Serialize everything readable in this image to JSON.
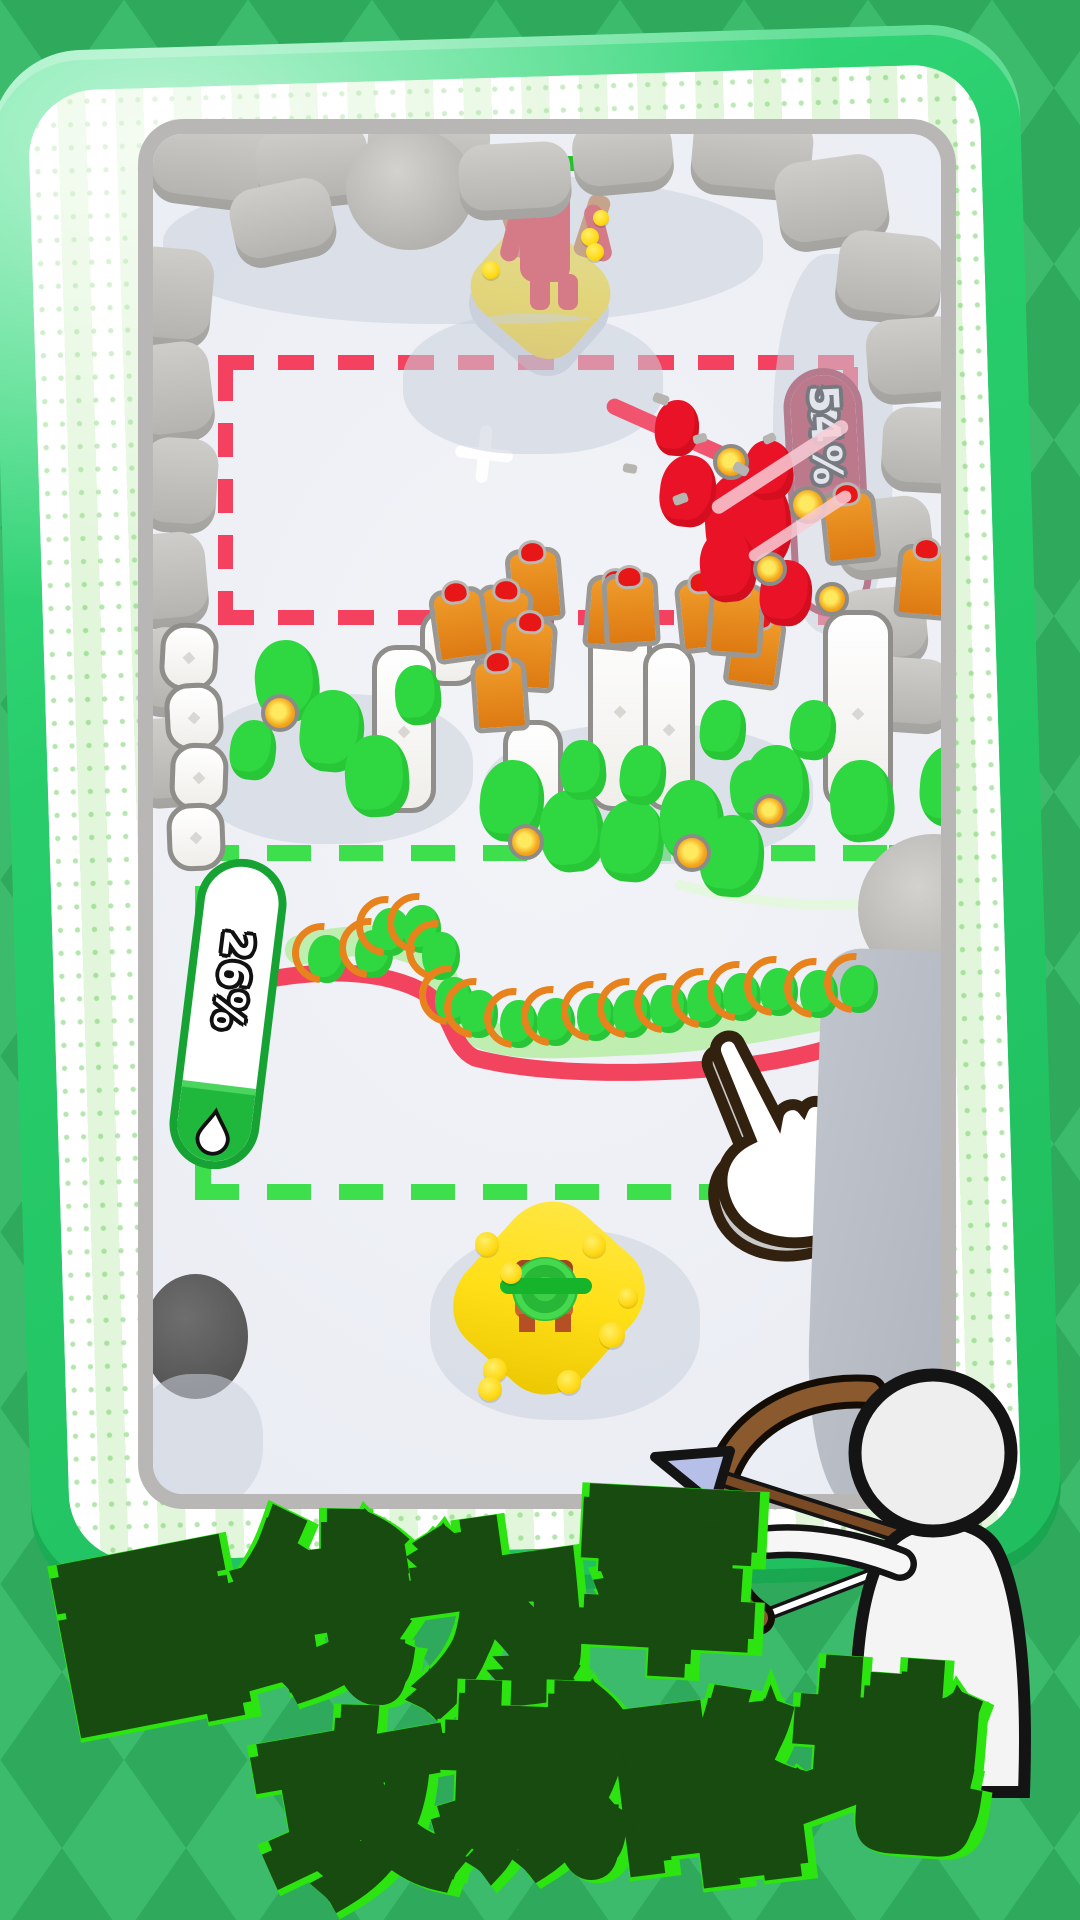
{
  "promo": {
    "caption_line1": "画线为军",
    "caption_line2": "攻城略地"
  },
  "hud": {
    "enemy_capture_meter": {
      "value": "54%",
      "icon": "droplet-icon"
    },
    "ally_capture_meter": {
      "value": "26%",
      "icon": "droplet-icon"
    },
    "ad_button": {
      "icon": "lightning-bolt-icon",
      "badge_icon": "video-play-icon",
      "badge_glyph": "▶"
    }
  },
  "colors": {
    "background_green": "#3dbb6d",
    "frame_green": "#28cd6b",
    "enemy_red": "#ac0f2c",
    "enemy_dash": "#f4415f",
    "ally_green": "#1fb83d",
    "ally_dash": "#3ddf4d",
    "base_yellow": "#ffdf17",
    "caption_glow": "#2ce410"
  }
}
